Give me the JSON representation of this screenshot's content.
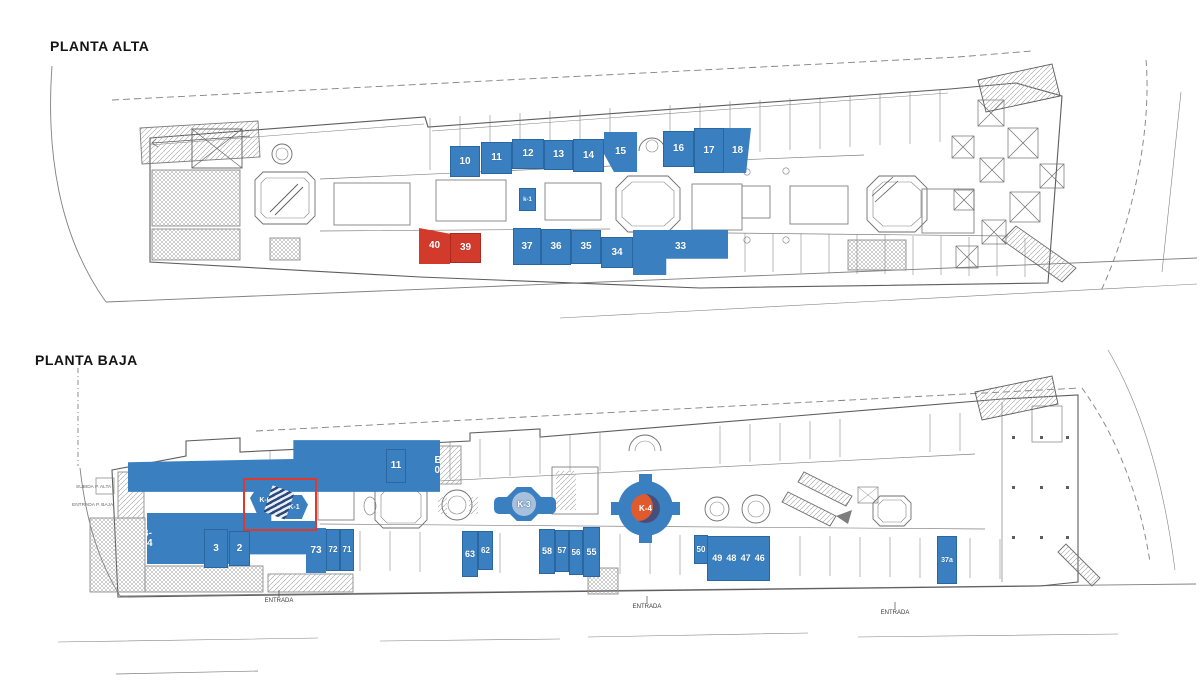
{
  "page": {
    "background": "#ffffff"
  },
  "colors": {
    "unit_blue": "#3a80c1",
    "unit_red": "#d23a2c",
    "highlight_red": "#e0392c",
    "kiosk_inner_light": "#a9c0dc",
    "kiosk_inner_orange": "#df5a2d"
  },
  "floors": [
    {
      "id": "planta-alta",
      "title": "PLANTA ALTA",
      "units": [
        {
          "id": "u10",
          "label": "10",
          "color": "blue",
          "x": 450,
          "y": 146,
          "w": 30,
          "h": 31
        },
        {
          "id": "u11",
          "label": "11",
          "color": "blue",
          "x": 481,
          "y": 142,
          "w": 31,
          "h": 32
        },
        {
          "id": "u12",
          "label": "12",
          "color": "blue",
          "x": 512,
          "y": 139,
          "w": 32,
          "h": 30
        },
        {
          "id": "u13",
          "label": "13",
          "color": "blue",
          "x": 544,
          "y": 140,
          "w": 29,
          "h": 30
        },
        {
          "id": "u14",
          "label": "14",
          "color": "blue",
          "x": 573,
          "y": 139,
          "w": 31,
          "h": 33
        },
        {
          "id": "u15",
          "label": "15",
          "color": "blue",
          "x": 604,
          "y": 132,
          "w": 33,
          "h": 40
        },
        {
          "id": "u16",
          "label": "16",
          "color": "blue",
          "x": 663,
          "y": 131,
          "w": 31,
          "h": 36
        },
        {
          "id": "u17",
          "label": "17",
          "color": "blue",
          "x": 694,
          "y": 128,
          "w": 30,
          "h": 45
        },
        {
          "id": "u18",
          "label": "18",
          "color": "blue",
          "x": 724,
          "y": 128,
          "w": 27,
          "h": 45
        },
        {
          "id": "uk1a",
          "label": "k-1",
          "color": "blue",
          "x": 519,
          "y": 188,
          "w": 17,
          "h": 23
        },
        {
          "id": "u40",
          "label": "40",
          "color": "red",
          "x": 419,
          "y": 228,
          "w": 31,
          "h": 36
        },
        {
          "id": "u39",
          "label": "39",
          "color": "red",
          "x": 450,
          "y": 233,
          "w": 31,
          "h": 30
        },
        {
          "id": "u37",
          "label": "37",
          "color": "blue",
          "x": 513,
          "y": 228,
          "w": 28,
          "h": 37
        },
        {
          "id": "u36",
          "label": "36",
          "color": "blue",
          "x": 541,
          "y": 229,
          "w": 30,
          "h": 36
        },
        {
          "id": "u35",
          "label": "35",
          "color": "blue",
          "x": 571,
          "y": 230,
          "w": 30,
          "h": 34
        },
        {
          "id": "u34",
          "label": "34",
          "color": "blue",
          "x": 601,
          "y": 237,
          "w": 32,
          "h": 31
        },
        {
          "id": "u33",
          "label": "33",
          "color": "blue",
          "x": 633,
          "y": 230,
          "w": 95,
          "h": 45
        }
      ]
    },
    {
      "id": "planta-baja",
      "title": "PLANTA BAJA",
      "units": [
        {
          "id": "uB05",
          "label": "B-05",
          "color": "blue",
          "x": 128,
          "y": 439,
          "w": 110,
          "h": 54
        },
        {
          "id": "uB04",
          "label": "B-04",
          "color": "blue",
          "x": 147,
          "y": 512,
          "w": 60,
          "h": 53
        },
        {
          "id": "uK0",
          "label": "K-0",
          "color": "blue",
          "x": 250,
          "y": 488,
          "w": 30,
          "h": 25,
          "shape": "hex"
        },
        {
          "id": "uK1b",
          "label": "K-1",
          "color": "blue",
          "x": 280,
          "y": 495,
          "w": 28,
          "h": 24,
          "shape": "hex"
        },
        {
          "id": "u3",
          "label": "3",
          "color": "blue",
          "x": 204,
          "y": 529,
          "w": 24,
          "h": 39
        },
        {
          "id": "u2",
          "label": "2",
          "color": "blue",
          "x": 229,
          "y": 531,
          "w": 21,
          "h": 35
        },
        {
          "id": "u11b",
          "label": "11",
          "color": "blue",
          "x": 386,
          "y": 449,
          "w": 20,
          "h": 34
        },
        {
          "id": "u73",
          "label": "73",
          "color": "blue",
          "x": 306,
          "y": 528,
          "w": 20,
          "h": 45
        },
        {
          "id": "u72",
          "label": "72",
          "color": "blue",
          "x": 326,
          "y": 529,
          "w": 14,
          "h": 42
        },
        {
          "id": "u71",
          "label": "71",
          "color": "blue",
          "x": 340,
          "y": 529,
          "w": 14,
          "h": 42
        },
        {
          "id": "u63",
          "label": "63",
          "color": "blue",
          "x": 462,
          "y": 531,
          "w": 16,
          "h": 46
        },
        {
          "id": "u62",
          "label": "62",
          "color": "blue",
          "x": 478,
          "y": 531,
          "w": 15,
          "h": 39
        },
        {
          "id": "u58",
          "label": "58",
          "color": "blue",
          "x": 539,
          "y": 529,
          "w": 16,
          "h": 45
        },
        {
          "id": "u57",
          "label": "57",
          "color": "blue",
          "x": 555,
          "y": 530,
          "w": 14,
          "h": 42
        },
        {
          "id": "u56",
          "label": "56",
          "color": "blue",
          "x": 569,
          "y": 530,
          "w": 14,
          "h": 45
        },
        {
          "id": "u55",
          "label": "55",
          "color": "blue",
          "x": 583,
          "y": 527,
          "w": 17,
          "h": 50
        },
        {
          "id": "u50",
          "label": "50",
          "color": "blue",
          "x": 694,
          "y": 535,
          "w": 14,
          "h": 29
        },
        {
          "id": "u49_46",
          "labels": [
            "49",
            "48",
            "47",
            "46"
          ],
          "color": "blue",
          "x": 707,
          "y": 536,
          "w": 63,
          "h": 45
        },
        {
          "id": "u37a",
          "label": "37a",
          "color": "blue",
          "x": 937,
          "y": 536,
          "w": 20,
          "h": 48
        }
      ],
      "kiosks": [
        {
          "id": "k3",
          "label": "K-3"
        },
        {
          "id": "k4",
          "label": "K-4"
        }
      ],
      "highlight_box": {
        "x": 243,
        "y": 478,
        "w": 70,
        "h": 49
      },
      "entrance_labels": [
        {
          "text": "ENTRADA",
          "x": 279,
          "y": 598
        },
        {
          "text": "ENTRADA",
          "x": 647,
          "y": 604
        },
        {
          "text": "ENTRADA",
          "x": 895,
          "y": 610
        }
      ],
      "side_labels": [
        {
          "text": "SUBIDA P. ALTA",
          "x": 76,
          "y": 485
        },
        {
          "text": "ENTRADA P. BAJA",
          "x": 72,
          "y": 503
        }
      ]
    }
  ]
}
